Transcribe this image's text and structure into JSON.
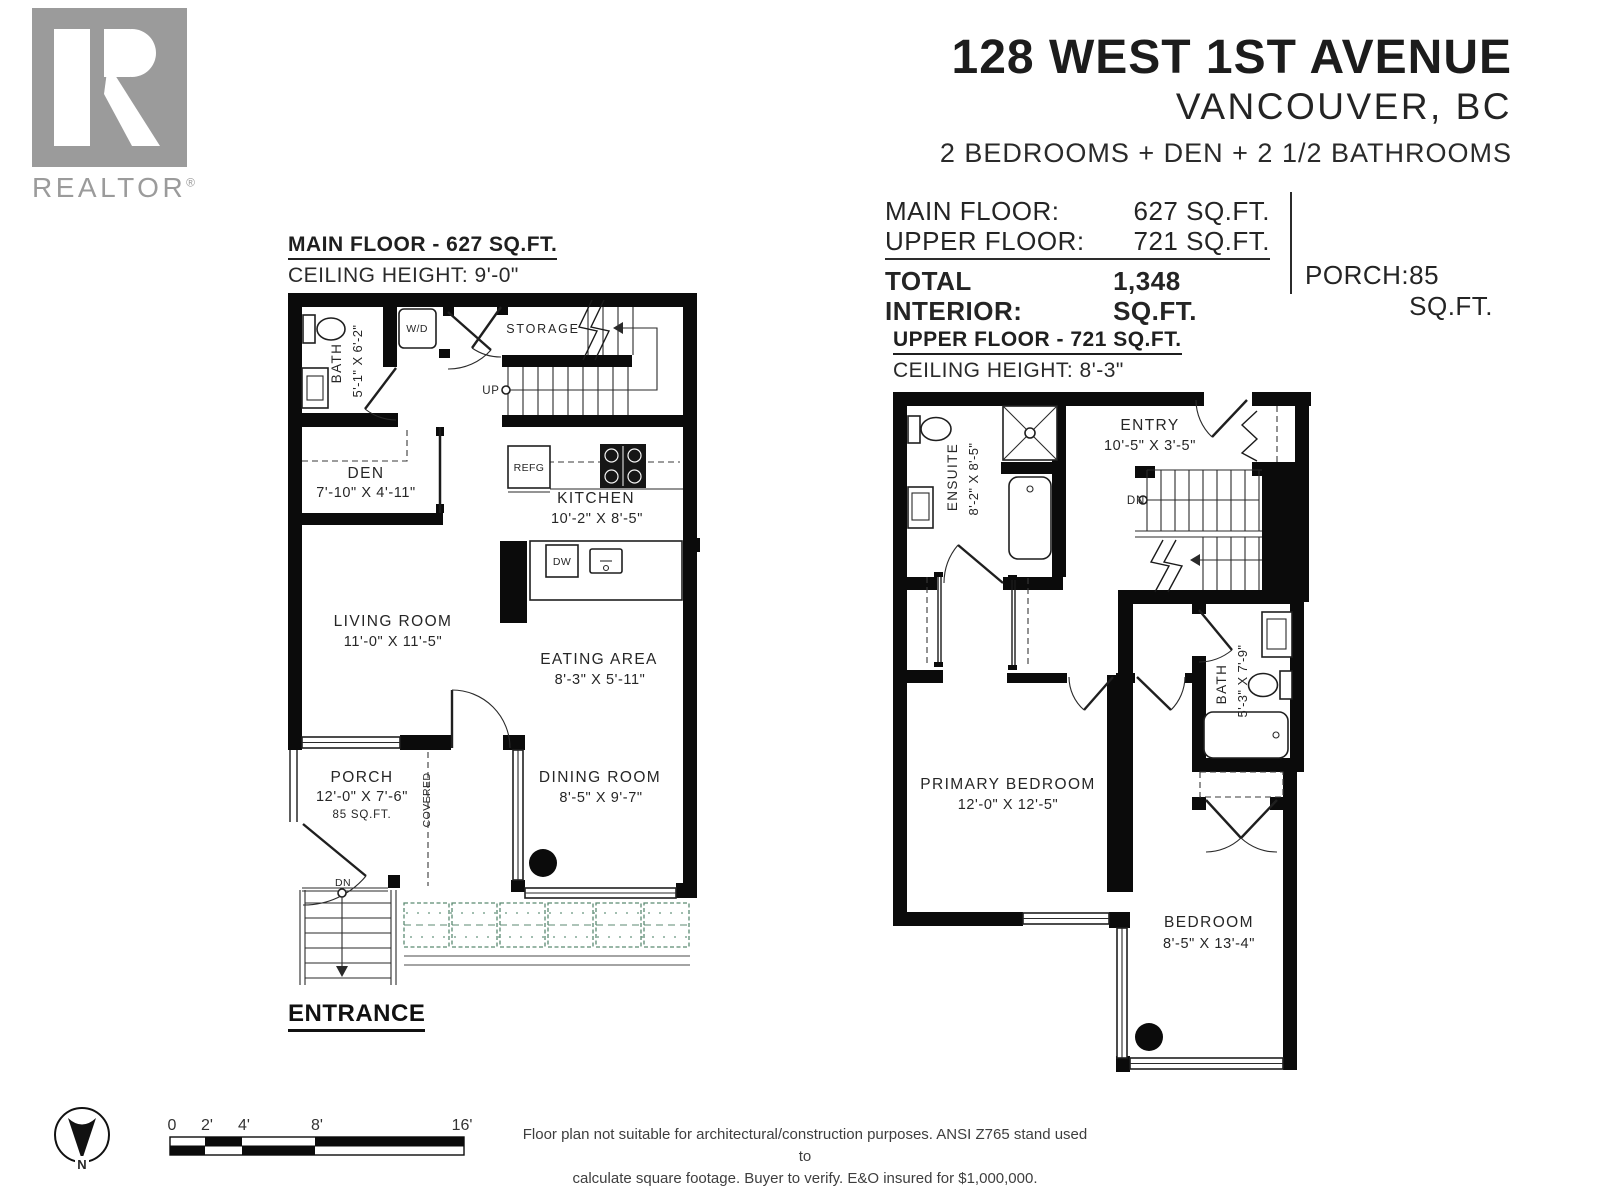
{
  "logo": {
    "brand": "REALTOR",
    "registered": "®"
  },
  "header": {
    "address": "128 WEST 1ST AVENUE",
    "city": "VANCOUVER, BC",
    "summary": "2 BEDROOMS + DEN + 2 1/2 BATHROOMS"
  },
  "area_summary": {
    "main_floor_label": "MAIN FLOOR:",
    "main_floor_value": "627 SQ.FT.",
    "upper_floor_label": "UPPER FLOOR:",
    "upper_floor_value": "721 SQ.FT.",
    "total_label": "TOTAL INTERIOR:",
    "total_value": "1,348 SQ.FT.",
    "porch_label": "PORCH:",
    "porch_value": "85 SQ.FT."
  },
  "main_floor": {
    "title": "MAIN FLOOR - 627 SQ.FT.",
    "ceiling": "CEILING HEIGHT: 9'-0\"",
    "bath": {
      "name": "BATH",
      "dims": "5'-1\" X 6'-2\""
    },
    "wd": "W/D",
    "storage": "STORAGE",
    "up": "UP",
    "den": {
      "name": "DEN",
      "dims": "7'-10\" X 4'-11\""
    },
    "refg": "REFG",
    "kitchen": {
      "name": "KITCHEN",
      "dims": "10'-2\" X 8'-5\""
    },
    "dw": "DW",
    "living": {
      "name": "LIVING ROOM",
      "dims": "11'-0\" X 11'-5\""
    },
    "eating": {
      "name": "EATING AREA",
      "dims": "8'-3\" X 5'-11\""
    },
    "porch": {
      "name": "PORCH",
      "dims": "12'-0\" X 7'-6\"",
      "area": "85 SQ.FT."
    },
    "covered": "COVERED",
    "dining": {
      "name": "DINING ROOM",
      "dims": "8'-5\" X 9'-7\""
    },
    "dn": "DN",
    "entrance": "ENTRANCE"
  },
  "upper_floor": {
    "title": "UPPER FLOOR - 721 SQ.FT.",
    "ceiling": "CEILING HEIGHT: 8'-3\"",
    "ensuite": {
      "name": "ENSUITE",
      "dims": "8'-2\" X 8'-5\""
    },
    "entry": {
      "name": "ENTRY",
      "dims": "10'-5\" X 3'-5\""
    },
    "dn": "DN",
    "bath": {
      "name": "BATH",
      "dims": "5'-3\" X 7'-9\""
    },
    "primary": {
      "name": "PRIMARY BEDROOM",
      "dims": "12'-0\" X 12'-5\""
    },
    "bedroom": {
      "name": "BEDROOM",
      "dims": "8'-5\" X 13'-4\""
    }
  },
  "compass": {
    "north": "N"
  },
  "scale_bar": {
    "ticks": [
      "0",
      "2'",
      "4'",
      "8'",
      "16'"
    ]
  },
  "disclaimer": {
    "line1": "Floor plan not suitable for architectural/construction purposes. ANSI Z765 stand used to",
    "line2": "calculate square footage. Buyer to verify.  E&O insured for $1,000,000."
  },
  "colors": {
    "wall": "#0b0b0b",
    "text": "#262626",
    "hedge": "#5b8a72",
    "logo_gray": "#9b9b9b"
  }
}
